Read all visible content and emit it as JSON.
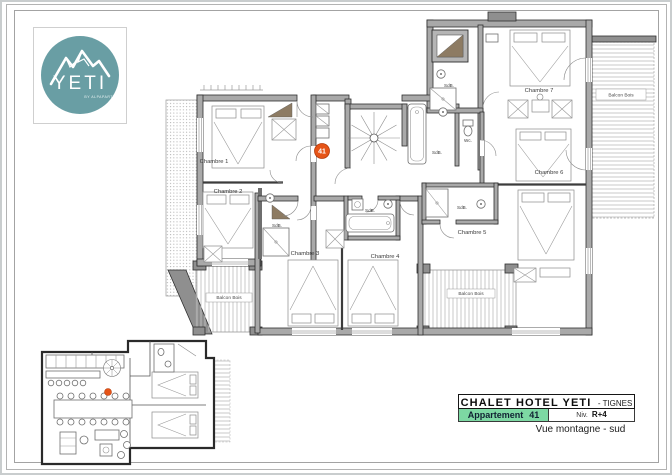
{
  "logo": {
    "brand": "YETI",
    "tagline": "BY ALPAPART"
  },
  "main_plan": {
    "marker": "41",
    "rooms": [
      {
        "label": "Chambre 1"
      },
      {
        "label": "Chambre 2"
      },
      {
        "label": "Chambre 3"
      },
      {
        "label": "Chambre 4"
      },
      {
        "label": "Chambre 5"
      },
      {
        "label": "Chambre 6"
      },
      {
        "label": "Chambre 7"
      }
    ],
    "bath_labels": [
      "SdB.",
      "SdB.",
      "SdB.",
      "SdB.",
      "SdB."
    ],
    "wc_label": "Wc.",
    "balcony_labels": [
      "Balcon Bois",
      "Balcon Bois",
      "Balcon Bois"
    ]
  },
  "title_block": {
    "hotel": "CHALET HOTEL YETI",
    "location": "- TIGNES",
    "apartment_label": "Appartement",
    "apartment_number": "41",
    "level_label": "Niv.",
    "level_value": "R+4",
    "view": "Vue montagne - sud"
  },
  "colors": {
    "accent_green": "#7dd8a3",
    "badge_orange": "#e65417",
    "logo_teal": "#699ea4",
    "wall_gray": "#a9a9a9"
  }
}
